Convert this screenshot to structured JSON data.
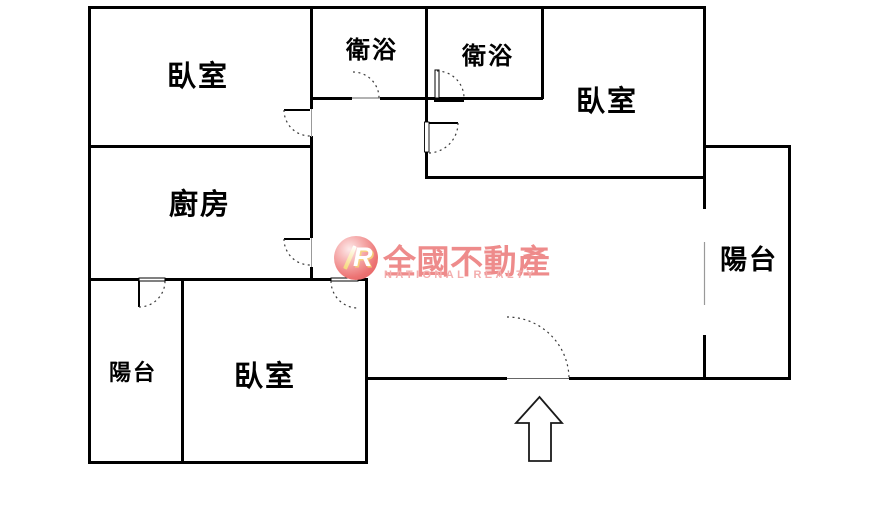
{
  "floorplan": {
    "background": "#ffffff",
    "wall_color": "#000000",
    "rooms": [
      {
        "id": "bedroom-top-left",
        "label": "臥室"
      },
      {
        "id": "bathroom-left",
        "label": "衛浴"
      },
      {
        "id": "bathroom-right",
        "label": "衛浴"
      },
      {
        "id": "bedroom-top-right",
        "label": "臥室"
      },
      {
        "id": "kitchen",
        "label": "廚房"
      },
      {
        "id": "balcony-right",
        "label": "陽台"
      },
      {
        "id": "balcony-bottom-left",
        "label": "陽台"
      },
      {
        "id": "bedroom-bottom",
        "label": "臥室"
      }
    ]
  },
  "logo": {
    "monogram": "R",
    "name_zh": "全國不動產",
    "name_en": "NATIONAL REALTY",
    "colors": {
      "zh_text": "#ee8b8b",
      "en_text": "#f3adad",
      "badge": "#ea6b6b",
      "monogram": "#ffffff",
      "monogram_accent": "#f6d879"
    }
  },
  "icons": {
    "entrance_arrow": "arrow-up",
    "logo_badge": "R-monogram-circle"
  }
}
